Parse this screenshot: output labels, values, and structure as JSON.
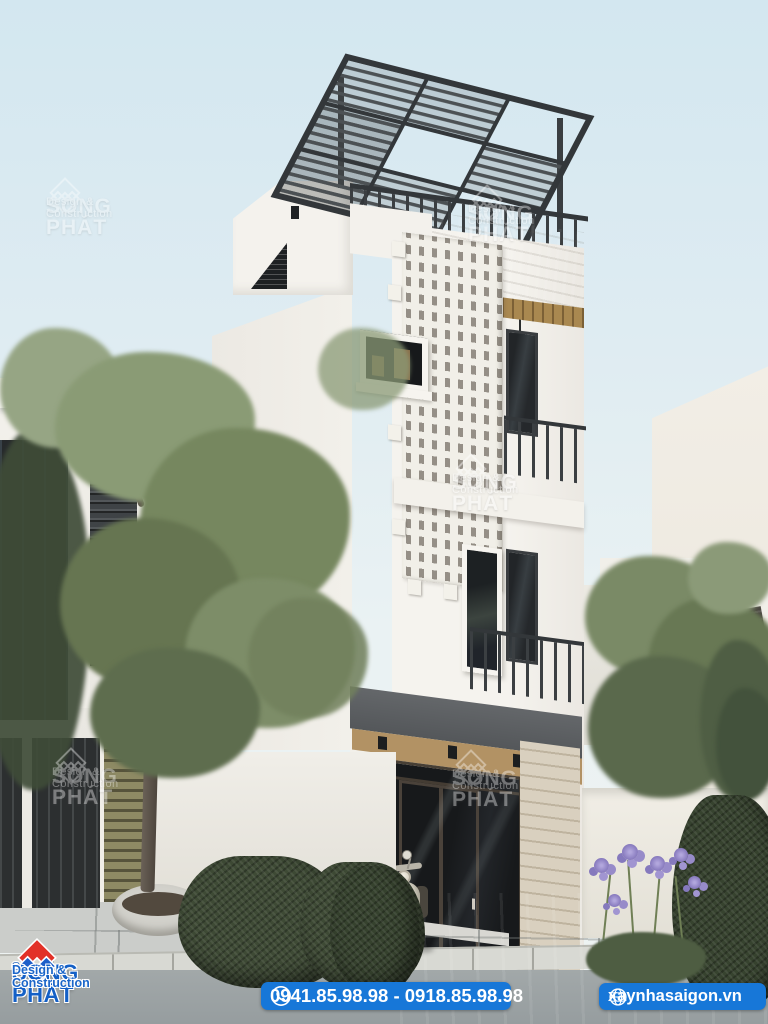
{
  "watermark": {
    "brand": "SONG PHÁT",
    "tagline": "Design & Construction",
    "icon": "song-phat-diamond-watermark"
  },
  "footer": {
    "logo": {
      "brand": "SONG PHÁT",
      "registered": "®",
      "tagline": "Design & Construction",
      "icon": "song-phat-diamond-logo"
    },
    "phone": {
      "label": "0941.85.98.98 - 0918.85.98.98",
      "icon": "phone-icon"
    },
    "website": {
      "label": "xaynhasaigon.vn",
      "icon": "globe-icon"
    }
  },
  "palette": {
    "accent_blue": "#1777d8",
    "logo_red": "#e23128",
    "logo_blue": "#1e5fc9",
    "brand_text_blue": "#1460c6",
    "sky": "#d9eaf2",
    "wall_white": "#f4f2ed",
    "steel_dark": "#3c4043",
    "concrete": "#b3a896",
    "wood": "#a98850",
    "hedge_green": "#3e4a35"
  },
  "scene": {
    "subject": "modern 4-storey townhouse elevation render with rooftop steel pergola, perforated breeze-block facade, balconies, street trees and wet pavement"
  }
}
